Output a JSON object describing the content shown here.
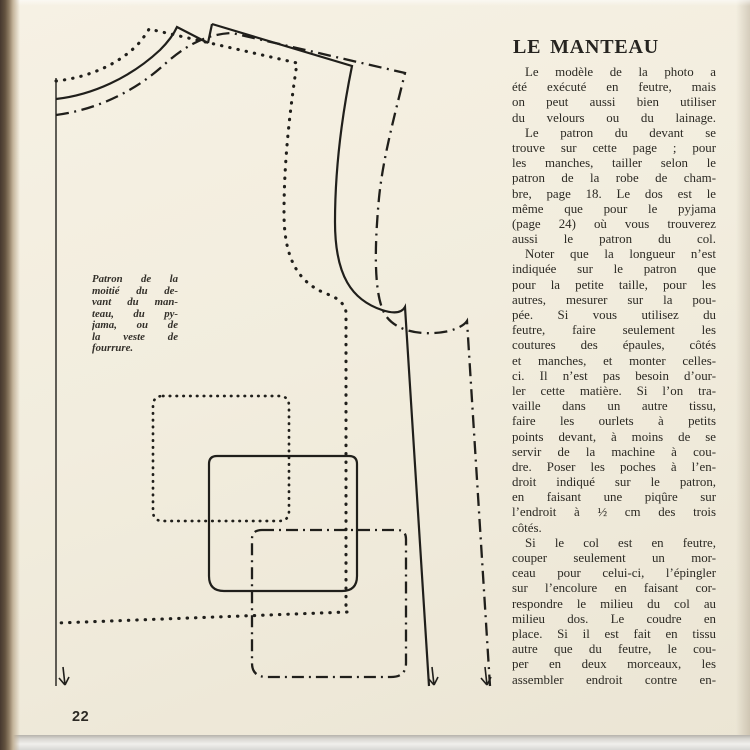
{
  "colors": {
    "paper": "#f2edde",
    "ink": "#2c2a24",
    "line": "#201f1b"
  },
  "page": {
    "number": "22"
  },
  "article": {
    "title": "LE MANTEAU",
    "paragraphs": [
      {
        "lines": [
          "Le modèle de la photo a",
          "été exécuté en feutre, mais",
          "on peut aussi bien utiliser",
          "du velours ou du lainage."
        ]
      },
      {
        "lines": [
          "Le patron du devant se",
          "trouve sur cette page ; pour",
          "les manches, tailler selon le",
          "patron de la robe de cham-",
          "bre, page 18. Le dos est le",
          "même que pour le pyjama",
          "(page 24) où vous trouverez",
          "aussi le patron du col."
        ]
      },
      {
        "lines": [
          "Noter que la longueur n’est",
          "indiquée sur le patron que",
          "pour la petite taille, pour les",
          "autres, mesurer sur la pou-",
          "pée. Si vous utilisez du",
          "feutre, faire seulement les",
          "coutures des épaules, côtés",
          "et manches, et monter celles-",
          "ci. Il n’est pas besoin d’our-",
          "ler cette matière. Si l’on tra-",
          "vaille dans un autre tissu,",
          "faire les ourlets à petits",
          "points devant, à moins de se",
          "servir de la machine à cou-",
          "dre. Poser les poches à l’en-",
          "droit indiqué sur le patron,",
          "en faisant une piqûre sur",
          "l’endroit à ½ cm des trois",
          "côtés."
        ]
      },
      {
        "lines": [
          "Si le col est en feutre,",
          "couper seulement un mor-",
          "ceau pour celui-ci, l’épingler",
          "sur l’encolure en faisant cor-",
          "respondre le milieu du col au",
          "milieu dos. Le coudre en",
          "place. Si il est fait en tissu",
          "autre que du feutre, le cou-",
          "per en deux morceaux, les",
          "assembler endroit contre en-"
        ]
      }
    ]
  },
  "diagram": {
    "caption_lines": [
      "Patron de la",
      "moitié du de-",
      "vant du man-",
      "teau, du py-",
      "jama, ou de",
      "la veste de",
      "fourrure."
    ]
  }
}
